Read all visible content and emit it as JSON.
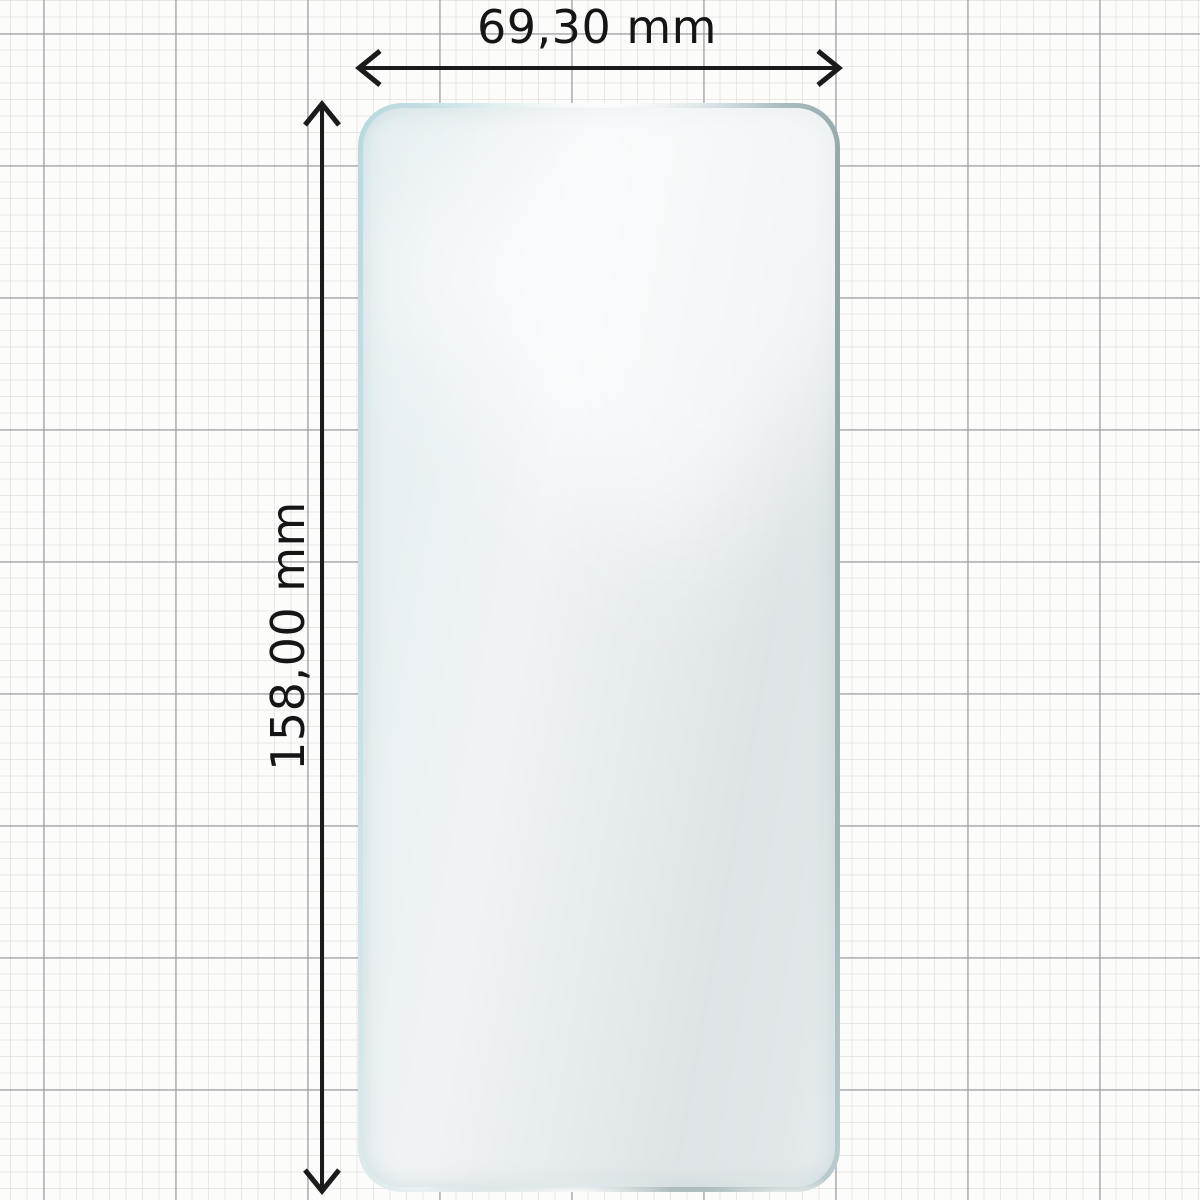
{
  "diagram": {
    "type": "product-dimension-diagram",
    "subject": "phone screen protector film on graph paper"
  },
  "dimensions": {
    "width_label": "69,30 mm",
    "height_label": "158,00 mm",
    "width_mm": 69.3,
    "height_mm": 158.0
  },
  "colors": {
    "dimension_line": "#1b1b1b",
    "film_border_light_blue": "#b7d9de",
    "film_border_silver": "#e9f0f3",
    "film_border_slate": "#91a5a7",
    "film_fill": "rgba(241,244,246,0.80)",
    "grid_minor": "rgba(208,198,190,0.38)",
    "grid_major": "rgba(148,150,156,0.55)",
    "paper_background": "#fcfcfb"
  }
}
